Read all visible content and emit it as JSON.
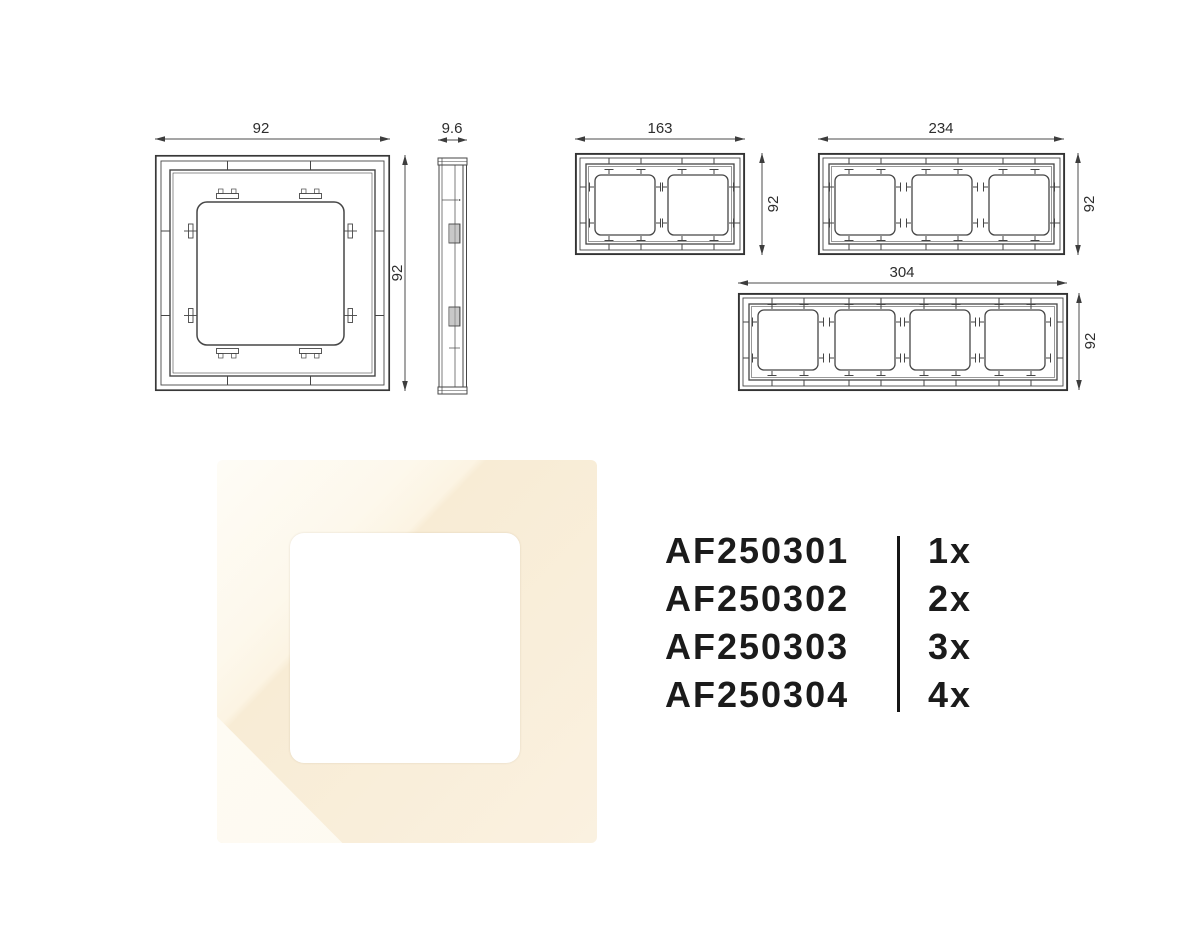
{
  "figures": {
    "one_gang": {
      "width": "92",
      "height": "92"
    },
    "side_view": {
      "thickness": "9.6"
    },
    "two_gang": {
      "width": "163",
      "height": "92"
    },
    "three_gang": {
      "width": "234",
      "height": "92"
    },
    "four_gang": {
      "width": "304",
      "height": "92"
    }
  },
  "photo": {
    "frame_color": "#f8ecd6",
    "highlight_color": "#fdfaf2",
    "opening_color": "#ffffff"
  },
  "codes": {
    "items": [
      {
        "code": "AF250301",
        "qty": "1x"
      },
      {
        "code": "AF250302",
        "qty": "2x"
      },
      {
        "code": "AF250303",
        "qty": "3x"
      },
      {
        "code": "AF250304",
        "qty": "4x"
      }
    ]
  }
}
